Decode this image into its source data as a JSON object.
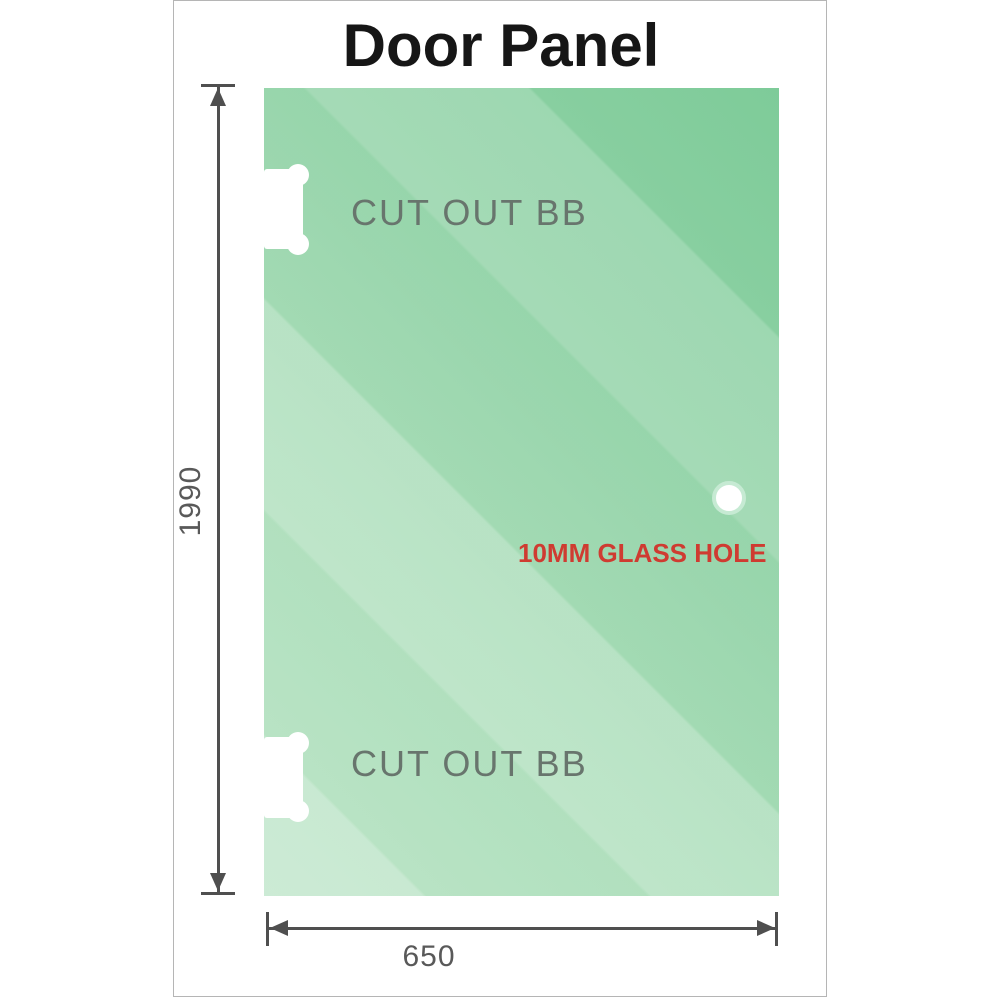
{
  "title": "Door Panel",
  "labels": {
    "cutout_top": "CUT OUT BB",
    "cutout_bottom": "CUT OUT BB",
    "glass_hole": "10MM GLASS HOLE"
  },
  "measurements": {
    "panel_height": "1990",
    "panel_width": "650"
  },
  "colors": {
    "glass_green": "#92d3a7",
    "glass_highlight": "#bce6c9",
    "hole_ring": "#c6ead3",
    "dimension_gray": "#4f4f4f",
    "label_gray": "#68756d",
    "hole_text_red": "#cf3b31",
    "frame_border": "#b5b5b5"
  }
}
